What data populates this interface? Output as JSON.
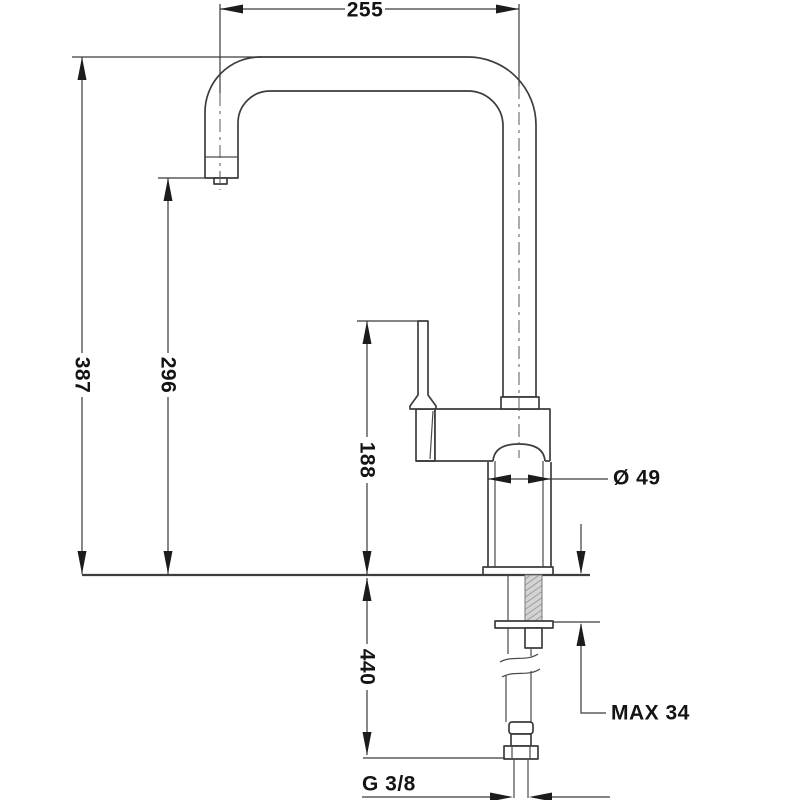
{
  "drawing": {
    "subject": "Kitchen faucet (single-lever, high U-shaped spout) installation dimension drawing, front view",
    "units": "mm",
    "background_color": "#ffffff",
    "line_color": "#3d3d3d",
    "text_color": "#141414",
    "labels": {
      "spout_reach": "255",
      "overall_height": "387",
      "spout_outlet_height": "296",
      "lever_top_height": "188",
      "body_diameter": "Ø 49",
      "hose_length_below_deck": "440",
      "max_deck_thickness": "MAX 34",
      "supply_connection_thread": "G 3/8"
    }
  }
}
